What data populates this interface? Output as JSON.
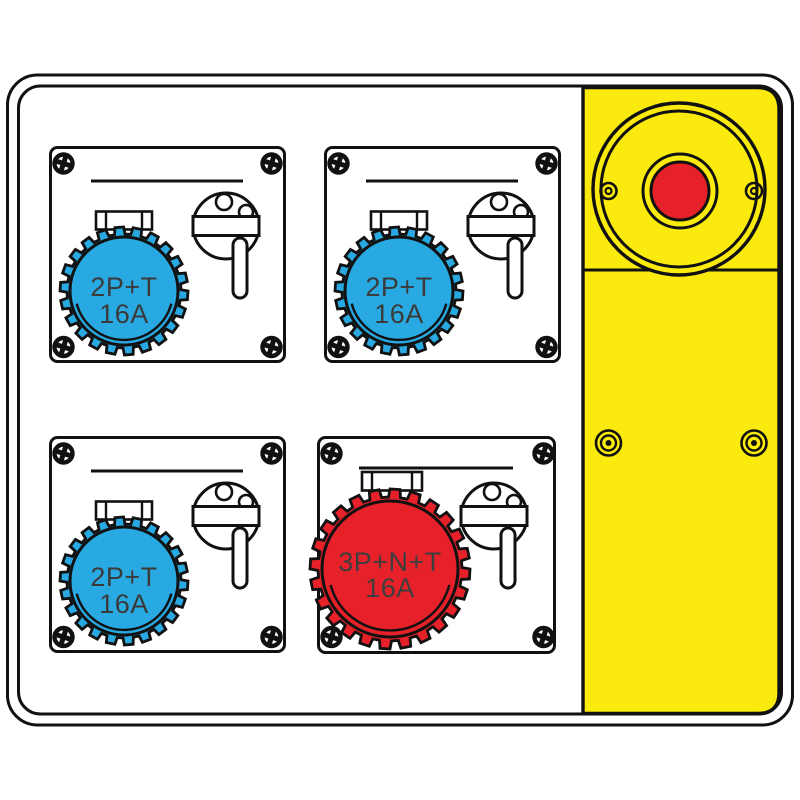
{
  "drawing": {
    "title": "distribution board line drawing with four interlocked sockets and emergency stop",
    "colors": {
      "outline": "#111111",
      "socket_blue": "#29A9E1",
      "socket_red": "#E6212A",
      "panel_yellow": "#FBEA0D",
      "label_text": "#3A3A3A",
      "background": "#FFFFFF"
    },
    "modules": [
      {
        "name": "socket-top-left",
        "label_line1": "2P+T",
        "label_line2": "16A",
        "color": "#29A9E1"
      },
      {
        "name": "socket-top-right",
        "label_line1": "2P+T",
        "label_line2": "16A",
        "color": "#29A9E1"
      },
      {
        "name": "socket-bottom-left",
        "label_line1": "2P+T",
        "label_line2": "16A",
        "color": "#29A9E1"
      },
      {
        "name": "socket-bottom-right",
        "label_line1": "3P+N+T",
        "label_line2": "16A",
        "color": "#E6212A"
      }
    ],
    "estop": {
      "button_color": "#E6212A",
      "panel_color": "#FBEA0D"
    }
  }
}
